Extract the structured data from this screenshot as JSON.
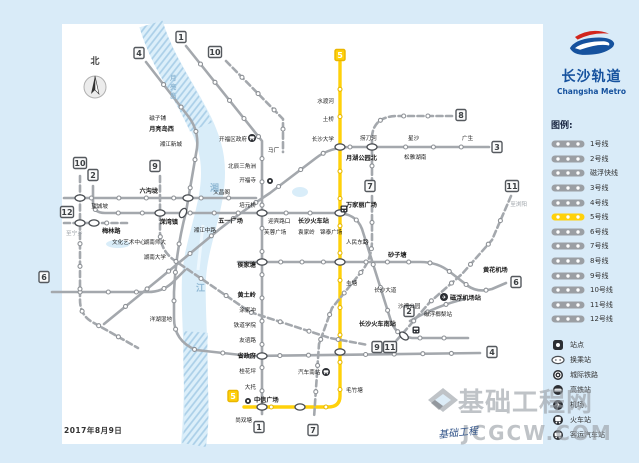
{
  "logo": {
    "cn": "长沙轨道",
    "en": "Changsha Metro",
    "blue": "#16529e",
    "red": "#d1251d"
  },
  "date": "2017年8月9日",
  "compass": "北",
  "watermark": {
    "cn": "基础工程网",
    "en": "JCGCW.COM",
    "script": "基础工程"
  },
  "legend": {
    "header": "图例:",
    "lines": [
      {
        "label": "1号线"
      },
      {
        "label": "2号线"
      },
      {
        "label": "磁浮快线"
      },
      {
        "label": "3号线"
      },
      {
        "label": "4号线"
      },
      {
        "label": "5号线",
        "color": "#ffd10a"
      },
      {
        "label": "6号线"
      },
      {
        "label": "7号线"
      },
      {
        "label": "8号线"
      },
      {
        "label": "9号线"
      },
      {
        "label": "10号线"
      },
      {
        "label": "11号线"
      },
      {
        "label": "12号线"
      }
    ],
    "icons": [
      {
        "label": "站点",
        "type": "station"
      },
      {
        "label": "换乘站",
        "type": "transfer"
      },
      {
        "label": "城际铁路",
        "type": "intercity"
      },
      {
        "label": "高铁站",
        "type": "hsr"
      },
      {
        "label": "机场",
        "type": "airport"
      },
      {
        "label": "火车站",
        "type": "railway"
      },
      {
        "label": "客运汽车站",
        "type": "bus"
      }
    ]
  },
  "map": {
    "bg": "#d9ebf8",
    "card": "#ffffff",
    "line_gray": "#a4a8ad",
    "line_yellow": "#ffd10a",
    "dot_yellow": "#e8b900",
    "river": "#d9edf9",
    "river_hatch": "#aacfe8",
    "river_path": "M151,24 C166,75 206,115 212,158 C218,200 196,238 194,278 C192,318 200,368 193,445",
    "river_hatch_top": "M151,24 C163,65 188,95 201,127",
    "river_hatch_bottom": "M196,332 C193,372 200,410 194,445",
    "lakes": [
      [
        118,
        244,
        12,
        4
      ],
      [
        300,
        192,
        8,
        5
      ]
    ],
    "lines": [
      {
        "id": "line-1",
        "d": "M186,46 L262,141 L262,414",
        "n": 16
      },
      {
        "id": "line-2",
        "d": "M93,186 L93,202 Q93,213 105,213 L336,213 Q356,213 362,229 L390,318 Q395,336 412,338 L468,338",
        "n": 19
      },
      {
        "id": "line-3",
        "d": "M489,147 L352,147 Q330,147 316,158 L270,193 Q235,216 210,237 L158,280 L104,324",
        "n": 15
      },
      {
        "id": "line-4",
        "d": "M146,62 L188,116 Q199,130 197,148 L186,212 Q176,250 174,292 L174,318 Q174,341 196,350 L250,356 L480,353",
        "n": 20
      },
      {
        "id": "line-5",
        "d": "M340,62 L340,396 Q340,407 328,407 L244,407",
        "n": 15,
        "yellow": 1,
        "w": 3.4
      },
      {
        "id": "line-6w",
        "d": "M64,198 L256,198",
        "n": 6
      },
      {
        "id": "line-6e",
        "d": "M238,262 L420,262 Q438,262 450,272 L468,286 Q478,293 492,289 L506,283",
        "n": 12
      },
      {
        "id": "line-6sw",
        "d": "M52,292 L148,292 Q162,292 172,283 L185,270",
        "n": 4
      },
      {
        "id": "maglev",
        "d": "M410,321 Q438,305 465,299",
        "n": 2
      },
      {
        "id": "line-7",
        "d": "M372,196 L372,240 Q372,258 362,271 L332,308 L319,344 L314,418",
        "n": 8,
        "dash": 1
      },
      {
        "id": "line-8",
        "d": "M452,116 L398,116 Q374,116 372,136 L372,190",
        "n": 5,
        "dash": 1
      },
      {
        "id": "line-9",
        "d": "M160,176 L160,232 Q160,250 174,260 L250,312 L330,338 L368,345",
        "n": 9,
        "dash": 1
      },
      {
        "id": "line-10n",
        "d": "M226,61 L283,119 L283,152",
        "n": 4,
        "dash": 1
      },
      {
        "id": "line-10w",
        "d": "M80,176 L80,300 Q80,316 94,323 L138,348",
        "n": 8,
        "dash": 1
      },
      {
        "id": "line-11",
        "d": "M511,196 L492,240 L462,274 L430,302 L404,332 L396,341",
        "n": 6,
        "dash": 1
      },
      {
        "id": "line-12",
        "d": "M64,223 L128,223",
        "n": 2,
        "dash": 1
      }
    ],
    "badges": [
      {
        "n": "1",
        "x": 181,
        "y": 37
      },
      {
        "n": "1",
        "x": 259,
        "y": 427
      },
      {
        "n": "2",
        "x": 93,
        "y": 175
      },
      {
        "n": "2",
        "x": 409,
        "y": 311
      },
      {
        "n": "3",
        "x": 497,
        "y": 147
      },
      {
        "n": "4",
        "x": 139,
        "y": 53
      },
      {
        "n": "4",
        "x": 492,
        "y": 352
      },
      {
        "n": "5",
        "x": 340,
        "y": 55,
        "y5": 1
      },
      {
        "n": "5",
        "x": 233,
        "y": 396,
        "y5": 1
      },
      {
        "n": "6",
        "x": 44,
        "y": 277
      },
      {
        "n": "6",
        "x": 516,
        "y": 282
      },
      {
        "n": "7",
        "x": 370,
        "y": 186
      },
      {
        "n": "7",
        "x": 313,
        "y": 430
      },
      {
        "n": "8",
        "x": 461,
        "y": 115
      },
      {
        "n": "9",
        "x": 155,
        "y": 166
      },
      {
        "n": "9",
        "x": 377,
        "y": 347
      },
      {
        "n": "10",
        "x": 215,
        "y": 52
      },
      {
        "n": "10",
        "x": 80,
        "y": 163
      },
      {
        "n": "11",
        "x": 512,
        "y": 186
      },
      {
        "n": "11",
        "x": 390,
        "y": 347
      },
      {
        "n": "12",
        "x": 67,
        "y": 212
      }
    ],
    "transfers": [
      [
        262,
        213
      ],
      [
        340,
        213
      ],
      [
        183,
        213,
        -60
      ],
      [
        262,
        262
      ],
      [
        340,
        262
      ],
      [
        340,
        147
      ],
      [
        372,
        147
      ],
      [
        262,
        356
      ],
      [
        340,
        352
      ],
      [
        404,
        336,
        40
      ],
      [
        188,
        198
      ],
      [
        80,
        223
      ],
      [
        94,
        223
      ],
      [
        160,
        213
      ],
      [
        262,
        407
      ],
      [
        300,
        407
      ],
      [
        80,
        198
      ]
    ],
    "icons": [
      {
        "type": "train",
        "x": 344,
        "y": 209
      },
      {
        "type": "train",
        "x": 416,
        "y": 330
      },
      {
        "type": "bus",
        "x": 326,
        "y": 372
      },
      {
        "type": "bus",
        "x": 252,
        "y": 138
      },
      {
        "type": "airport",
        "x": 444,
        "y": 297
      },
      {
        "type": "intercity",
        "x": 248,
        "y": 401
      },
      {
        "type": "intercity",
        "x": 270,
        "y": 181
      }
    ],
    "labels": [
      {
        "t": "磁子铺",
        "x": 166,
        "y": 120,
        "a": "e"
      },
      {
        "t": "月亮岛西",
        "x": 174,
        "y": 131,
        "a": "e",
        "b": 1
      },
      {
        "t": "湘江新城",
        "x": 182,
        "y": 146,
        "a": "e"
      },
      {
        "t": "开福区政府",
        "x": 247,
        "y": 141,
        "a": "e"
      },
      {
        "t": "马厂",
        "x": 268,
        "y": 152
      },
      {
        "t": "北辰三角洲",
        "x": 256,
        "y": 168,
        "a": "e"
      },
      {
        "t": "开福寺",
        "x": 256,
        "y": 182,
        "a": "e"
      },
      {
        "t": "文昌阁",
        "x": 230,
        "y": 194,
        "a": "e"
      },
      {
        "t": "培元桥",
        "x": 256,
        "y": 207,
        "a": "e"
      },
      {
        "t": "六沟垅",
        "x": 158,
        "y": 193,
        "a": "e",
        "b": 1
      },
      {
        "t": "望城坡",
        "x": 108,
        "y": 208,
        "a": "e"
      },
      {
        "t": "溁湾镇",
        "x": 178,
        "y": 224,
        "a": "e",
        "b": 1
      },
      {
        "t": "湘江中路",
        "x": 216,
        "y": 232,
        "a": "e"
      },
      {
        "t": "五一广场",
        "x": 243,
        "y": 223,
        "a": "e",
        "b": 1
      },
      {
        "t": "迎宾路口",
        "x": 268,
        "y": 223
      },
      {
        "t": "长沙火车站",
        "x": 298,
        "y": 223,
        "b": 1
      },
      {
        "t": "芙蓉广场",
        "x": 264,
        "y": 234
      },
      {
        "t": "袁家岭",
        "x": 298,
        "y": 234
      },
      {
        "t": "锦泰广场",
        "x": 320,
        "y": 234
      },
      {
        "t": "万家丽广场",
        "x": 346,
        "y": 207,
        "b": 1
      },
      {
        "t": "人民东路",
        "x": 346,
        "y": 244
      },
      {
        "t": "侯家塘",
        "x": 256,
        "y": 267,
        "a": "e",
        "b": 1
      },
      {
        "t": "砂子塘",
        "x": 388,
        "y": 257,
        "b": 1
      },
      {
        "t": "黄土岭",
        "x": 256,
        "y": 297,
        "a": "e",
        "b": 1
      },
      {
        "t": "涂家冲",
        "x": 256,
        "y": 312,
        "a": "e"
      },
      {
        "t": "铁道学院",
        "x": 256,
        "y": 327,
        "a": "e"
      },
      {
        "t": "友谊路",
        "x": 256,
        "y": 342,
        "a": "e"
      },
      {
        "t": "省政府",
        "x": 256,
        "y": 358,
        "a": "e",
        "b": 1
      },
      {
        "t": "桂花坪",
        "x": 256,
        "y": 373,
        "a": "e"
      },
      {
        "t": "大托",
        "x": 256,
        "y": 389,
        "a": "e"
      },
      {
        "t": "中信广场",
        "x": 254,
        "y": 402,
        "b": 1
      },
      {
        "t": "尚双塘",
        "x": 252,
        "y": 422,
        "a": "e"
      },
      {
        "t": "湖南师大",
        "x": 166,
        "y": 244,
        "a": "e"
      },
      {
        "t": "湖南大学",
        "x": 166,
        "y": 259,
        "a": "e"
      },
      {
        "t": "洋湖湿地",
        "x": 172,
        "y": 321,
        "a": "e"
      },
      {
        "t": "梅林路",
        "x": 102,
        "y": 233,
        "b": 1
      },
      {
        "t": "文化艺术中心",
        "x": 112,
        "y": 244
      },
      {
        "t": "至宁乡",
        "x": 66,
        "y": 235,
        "g": 1
      },
      {
        "t": "至浏阳",
        "x": 527,
        "y": 206,
        "a": "e",
        "g": 1
      },
      {
        "t": "水渡河",
        "x": 334,
        "y": 103,
        "a": "e"
      },
      {
        "t": "土桥",
        "x": 334,
        "y": 121,
        "a": "e"
      },
      {
        "t": "长沙大学",
        "x": 334,
        "y": 141,
        "a": "e"
      },
      {
        "t": "月湖公园北",
        "x": 346,
        "y": 160,
        "b": 1
      },
      {
        "t": "捞刀河",
        "x": 360,
        "y": 140
      },
      {
        "t": "星沙",
        "x": 408,
        "y": 140
      },
      {
        "t": "松雅湖南",
        "x": 404,
        "y": 159
      },
      {
        "t": "广生",
        "x": 462,
        "y": 140
      },
      {
        "t": "圭塘",
        "x": 346,
        "y": 285
      },
      {
        "t": "毛竹塘",
        "x": 346,
        "y": 392
      },
      {
        "t": "汽车南站",
        "x": 298,
        "y": 374
      },
      {
        "t": "长沙大道",
        "x": 374,
        "y": 292
      },
      {
        "t": "沙湾公园",
        "x": 398,
        "y": 308
      },
      {
        "t": "长沙火车南站",
        "x": 396,
        "y": 326,
        "a": "e",
        "b": 1
      },
      {
        "t": "磁浮榔梨站",
        "x": 424,
        "y": 316
      },
      {
        "t": "磁浮机场站",
        "x": 450,
        "y": 300,
        "b": 1
      },
      {
        "t": "黄花机场",
        "x": 483,
        "y": 272,
        "b": 1
      },
      {
        "t": "湘",
        "x": 210,
        "y": 191,
        "r": 1
      },
      {
        "t": "江",
        "x": 196,
        "y": 291,
        "r": 1
      },
      {
        "t": "月亮岛",
        "x": 170,
        "y": 80,
        "r": 1,
        "v": 1
      }
    ]
  }
}
